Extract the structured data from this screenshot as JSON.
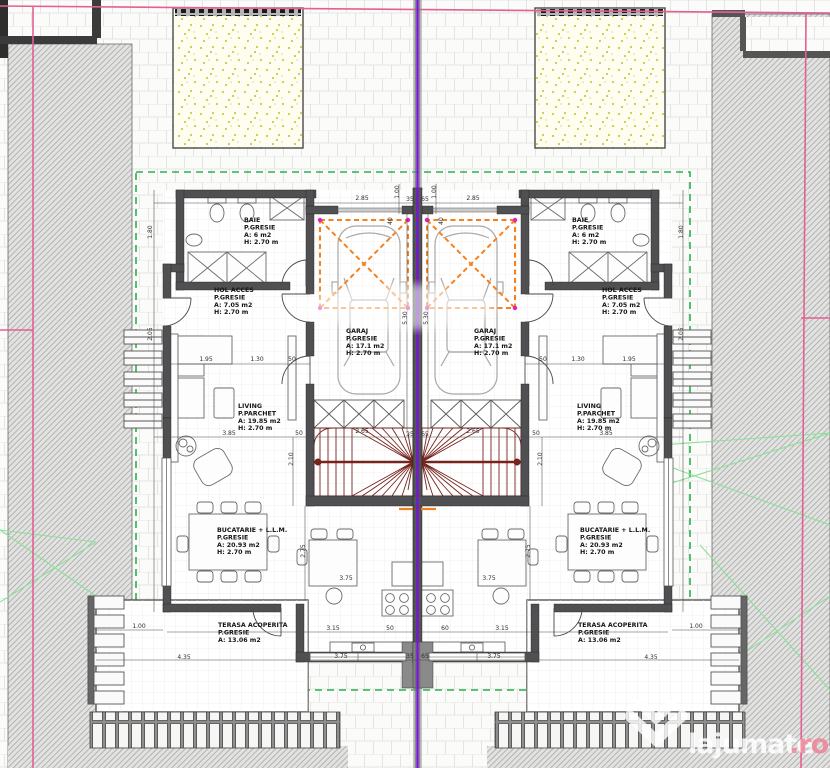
{
  "site": {
    "boundary_color": "#e55f94",
    "axis_color": "#7716d8",
    "setback_color": "#29b14e",
    "garage_zone_color": "#f5801e",
    "stair_color": "#77241f"
  },
  "rooms": [
    {
      "x": 244,
      "y": 222,
      "lines": [
        "BAIE",
        "P.GRESIE",
        "A: 6 m2",
        "H: 2.70 m"
      ]
    },
    {
      "x": 572,
      "y": 222,
      "lines": [
        "BAIE",
        "P.GRESIE",
        "A: 6 m2",
        "H: 2.70 m"
      ]
    },
    {
      "x": 214,
      "y": 292,
      "lines": [
        "HOL ACCES",
        "P.GRESIE",
        "A: 7.05 m2",
        "H: 2.70 m"
      ]
    },
    {
      "x": 602,
      "y": 292,
      "lines": [
        "HOL ACCES",
        "P.GRESIE",
        "A: 7.05 m2",
        "H: 2.70 m"
      ]
    },
    {
      "x": 346,
      "y": 333,
      "lines": [
        "GARAJ",
        "P.GRESIE",
        "A: 17.1 m2",
        "H: 2.70 m"
      ]
    },
    {
      "x": 474,
      "y": 333,
      "lines": [
        "GARAJ",
        "P.GRESIE",
        "A: 17.1 m2",
        "H: 2.70 m"
      ]
    },
    {
      "x": 238,
      "y": 408,
      "lines": [
        "LIVING",
        "P.PARCHET",
        "A: 19.85 m2",
        "H: 2.70 m"
      ]
    },
    {
      "x": 577,
      "y": 408,
      "lines": [
        "LIVING",
        "P.PARCHET",
        "A: 19.85 m2",
        "H: 2.70 m"
      ]
    },
    {
      "x": 217,
      "y": 532,
      "lines": [
        "BUCATARIE + L.L.M.",
        "P.GRESIE",
        "A: 20.93 m2",
        "H: 2.70 m"
      ]
    },
    {
      "x": 580,
      "y": 532,
      "lines": [
        "BUCATARIE + L.L.M.",
        "P.GRESIE",
        "A: 20.93 m2",
        "H: 2.70 m"
      ]
    },
    {
      "x": 218,
      "y": 627,
      "lines": [
        "TERASA ACOPERITA",
        "P.GRESIE",
        "A: 13.06 m2"
      ]
    },
    {
      "x": 578,
      "y": 627,
      "lines": [
        "TERASA ACOPERITA",
        "P.GRESIE",
        "A: 13.06 m2"
      ]
    }
  ],
  "dimensions": [
    {
      "v": "2.85",
      "x": 362,
      "y": 200
    },
    {
      "v": "2.85",
      "x": 473,
      "y": 200
    },
    {
      "v": "1.00",
      "x": 399,
      "y": 192,
      "r": 1
    },
    {
      "v": "1.00",
      "x": 436,
      "y": 192,
      "r": 1
    },
    {
      "v": "40",
      "x": 392,
      "y": 221,
      "r": 1
    },
    {
      "v": "40",
      "x": 443,
      "y": 221,
      "r": 1
    },
    {
      "v": "35",
      "x": 410,
      "y": 201
    },
    {
      "v": "65",
      "x": 425,
      "y": 201
    },
    {
      "v": "1.80",
      "x": 152,
      "y": 232,
      "r": 1
    },
    {
      "v": "2.05",
      "x": 152,
      "y": 334,
      "r": 1
    },
    {
      "v": "1.80",
      "x": 683,
      "y": 232,
      "r": 1
    },
    {
      "v": "2.05",
      "x": 683,
      "y": 334,
      "r": 1
    },
    {
      "v": "1.95",
      "x": 206,
      "y": 361
    },
    {
      "v": "1.30",
      "x": 257,
      "y": 361
    },
    {
      "v": "50",
      "x": 292,
      "y": 361
    },
    {
      "v": "50",
      "x": 543,
      "y": 361
    },
    {
      "v": "1.30",
      "x": 578,
      "y": 361
    },
    {
      "v": "1.95",
      "x": 629,
      "y": 361
    },
    {
      "v": "3.85",
      "x": 229,
      "y": 435
    },
    {
      "v": "50",
      "x": 299,
      "y": 435
    },
    {
      "v": "2.65",
      "x": 362,
      "y": 433
    },
    {
      "v": "2.65",
      "x": 473,
      "y": 433
    },
    {
      "v": "50",
      "x": 536,
      "y": 435
    },
    {
      "v": "3.85",
      "x": 606,
      "y": 435
    },
    {
      "v": "35",
      "x": 410,
      "y": 436
    },
    {
      "v": "65",
      "x": 425,
      "y": 436
    },
    {
      "v": "5.30",
      "x": 407,
      "y": 318,
      "r": 1
    },
    {
      "v": "5.30",
      "x": 428,
      "y": 318,
      "r": 1
    },
    {
      "v": "2.10",
      "x": 293,
      "y": 459,
      "r": 1
    },
    {
      "v": "2.10",
      "x": 542,
      "y": 459,
      "r": 1
    },
    {
      "v": "2.75",
      "x": 305,
      "y": 551,
      "r": 1
    },
    {
      "v": "2.75",
      "x": 530,
      "y": 551,
      "r": 1
    },
    {
      "v": "3.75",
      "x": 346,
      "y": 580
    },
    {
      "v": "3.75",
      "x": 489,
      "y": 580
    },
    {
      "v": "3.15",
      "x": 333,
      "y": 630
    },
    {
      "v": "50",
      "x": 390,
      "y": 630
    },
    {
      "v": "60",
      "x": 445,
      "y": 630
    },
    {
      "v": "3.15",
      "x": 502,
      "y": 630
    },
    {
      "v": "1.00",
      "x": 139,
      "y": 628
    },
    {
      "v": "4.35",
      "x": 184,
      "y": 659
    },
    {
      "v": "4.35",
      "x": 651,
      "y": 659
    },
    {
      "v": "1.00",
      "x": 696,
      "y": 628
    },
    {
      "v": "3.75",
      "x": 341,
      "y": 658
    },
    {
      "v": "3.75",
      "x": 494,
      "y": 658
    },
    {
      "v": "35",
      "x": 410,
      "y": 658
    },
    {
      "v": "65",
      "x": 425,
      "y": 658
    }
  ],
  "watermark": {
    "brand": "lajumate",
    "tld": ".ro"
  }
}
